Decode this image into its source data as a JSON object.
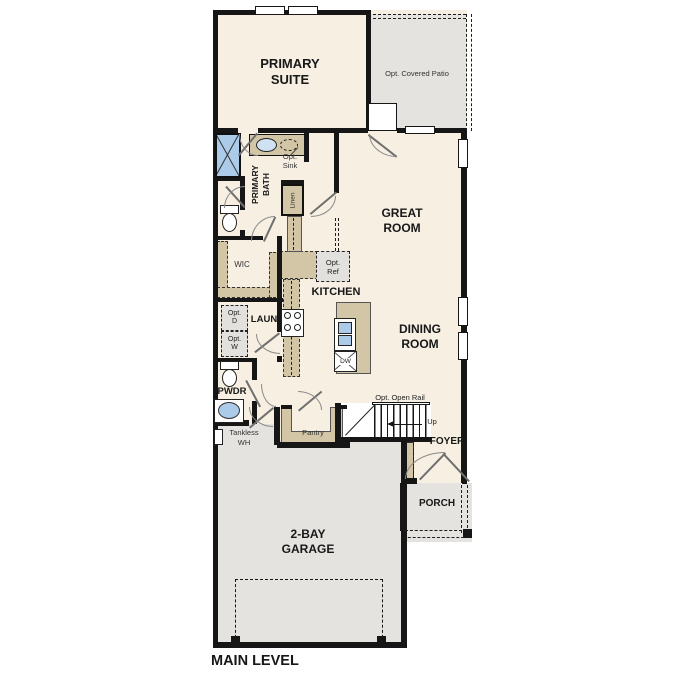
{
  "title": "MAIN LEVEL",
  "rooms": {
    "primary_suite": [
      "PRIMARY",
      "SUITE"
    ],
    "patio": "Opt. Covered Patio",
    "great_room": [
      "GREAT",
      "ROOM"
    ],
    "primary_bath": [
      "PRIMARY",
      "BATH"
    ],
    "opt_sink": [
      "Opt.",
      "Sink"
    ],
    "linen": "Linen",
    "wic": "WIC",
    "kitchen": "KITCHEN",
    "opt_ref": [
      "Opt.",
      "Ref"
    ],
    "dining_room": [
      "DINING",
      "ROOM"
    ],
    "laundry": "LAUN",
    "opt_d": [
      "Opt.",
      "D"
    ],
    "opt_w": [
      "Opt.",
      "W"
    ],
    "powder": "PWDR",
    "tankless": [
      "Tankless",
      "WH"
    ],
    "pantry": "Pantry",
    "stairs": {
      "rail": "Opt. Open Rail",
      "up": "Up"
    },
    "foyer": "FOYER",
    "porch": "PORCH",
    "garage": [
      "2-BAY",
      "GARAGE"
    ],
    "dishwasher": "DW"
  },
  "colors": {
    "floor": "#f6efe2",
    "wall": "#161616",
    "cabinet": "#d2c6a6",
    "exterior": "#e4e3e0",
    "optional_fill": "#e2e1de",
    "fixture_blue": "#abcbe9",
    "arc": "#8a8a8a"
  }
}
